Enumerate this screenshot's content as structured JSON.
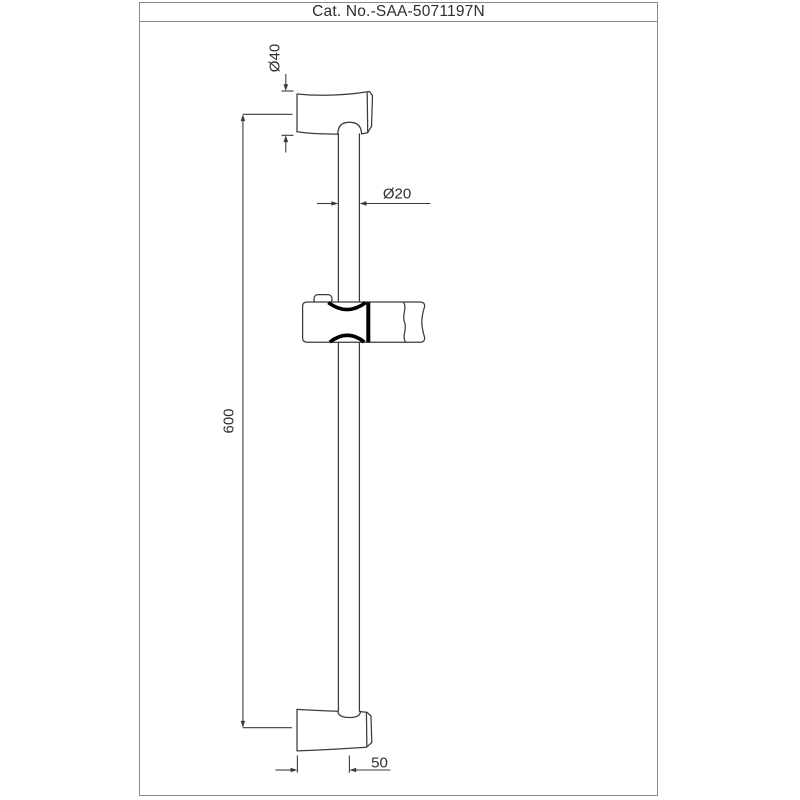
{
  "sheet": {
    "catalog_label": "Cat. No.-SAA-5071197N"
  },
  "drawing": {
    "dimensions": {
      "bracket_diameter": "Ø40",
      "rail_diameter": "Ø20",
      "rail_length": "600",
      "wall_offset": "50"
    },
    "colors": {
      "line": "#3b3b3b",
      "frame_border": "#8a8a8a",
      "clamp_highlight": "#000000",
      "background": "#ffffff"
    }
  }
}
